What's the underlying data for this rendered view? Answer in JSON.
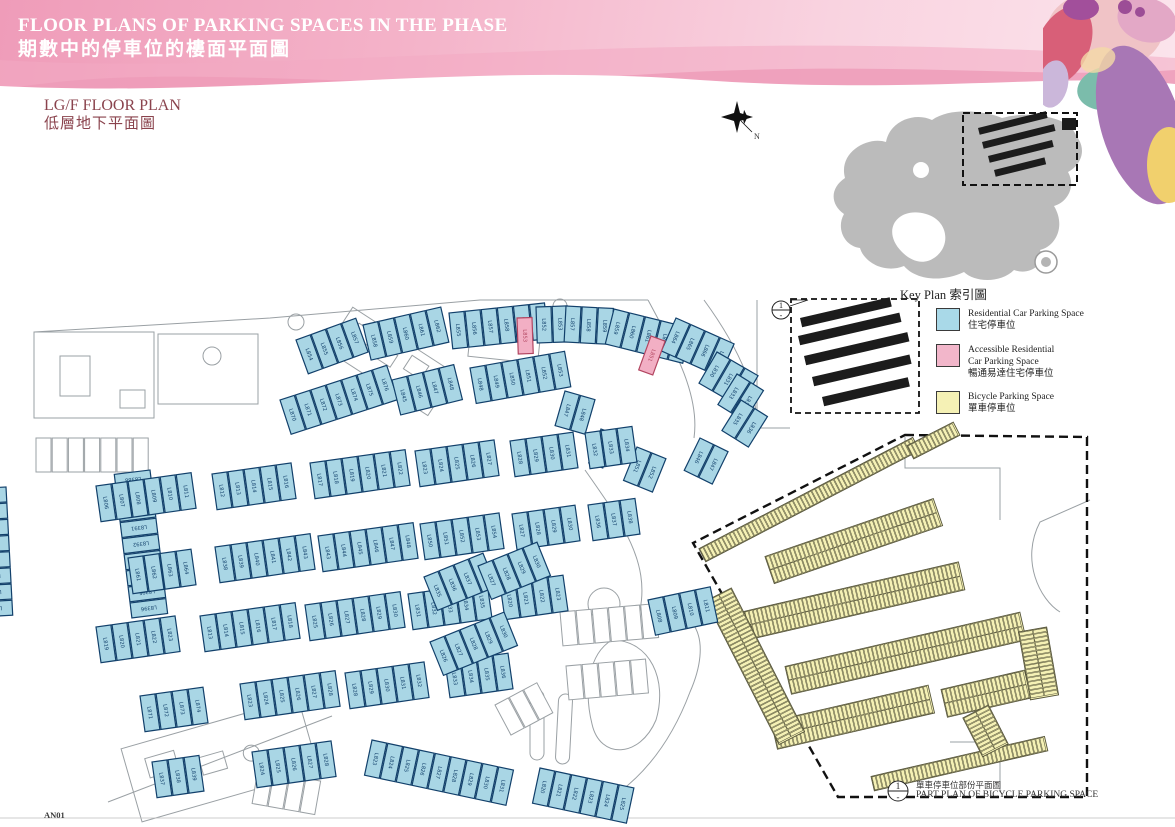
{
  "header": {
    "title_en": "FLOOR PLANS OF PARKING SPACES IN THE PHASE",
    "title_zh": "期數中的停車位的樓面平面圖"
  },
  "floor_title": {
    "en": "LG/F FLOOR PLAN",
    "zh": "低層地下平面圖"
  },
  "key_plan": {
    "caption_en": "Key Plan",
    "caption_zh": "索引圖"
  },
  "compass": {
    "label": "N"
  },
  "legend": {
    "items": [
      {
        "color": "#a9d9e8",
        "en1": "Residential Car Parking Space",
        "en2": "",
        "zh": "住宅停車位"
      },
      {
        "color": "#f2b6ca",
        "en1": "Accessible Residential",
        "en2": "Car Parking Space",
        "zh": "暢通易達住宅停車位"
      },
      {
        "color": "#f5f1b5",
        "en1": "Bicycle Parking Space",
        "en2": "",
        "zh": "單車停車位"
      }
    ]
  },
  "part_plan": {
    "ref": "1",
    "zh": "單車停車位部份平面圖",
    "en": "PART PLAN OF BICYCLE PARKING SPACE"
  },
  "sheet_no": "AN01",
  "plan": {
    "colors": {
      "blue_fill": "#a9d6e5",
      "blue_stroke": "#12406b",
      "pink_fill": "#f2afc4",
      "pink_stroke": "#b24560",
      "yellow_fill": "#f5f1b5",
      "yellow_stroke": "#55543a",
      "gray": "#9aa0a4",
      "black": "#1c1c1c"
    },
    "space": {
      "w": 15,
      "h": 36,
      "pitch": 16.2
    },
    "blue_clusters": [
      [
        296,
        340,
        -20,
        4,
        854
      ],
      [
        363,
        325,
        -13,
        5,
        858
      ],
      [
        449,
        313,
        -6,
        6,
        855
      ],
      [
        536,
        307,
        -2,
        2,
        852
      ],
      [
        566,
        306,
        3,
        3,
        857
      ],
      [
        614,
        309,
        14,
        5,
        859
      ],
      [
        676,
        318,
        24,
        4,
        864
      ],
      [
        717,
        352,
        30,
        3,
        830
      ],
      [
        737,
        374,
        32,
        2,
        833
      ],
      [
        741,
        400,
        32,
        2,
        835
      ],
      [
        565,
        391,
        16,
        2,
        847
      ],
      [
        601,
        429,
        20,
        1,
        849
      ],
      [
        637,
        447,
        22,
        2,
        851
      ],
      [
        700,
        438,
        26,
        2,
        846
      ],
      [
        280,
        400,
        -18,
        7,
        870
      ],
      [
        392,
        380,
        -14,
        4,
        845
      ],
      [
        470,
        368,
        -10,
        6,
        848
      ],
      [
        150,
        470,
        83,
        9,
        8388
      ],
      [
        6,
        487,
        87,
        8,
        8630
      ],
      [
        96,
        486,
        -8,
        6,
        806
      ],
      [
        212,
        474,
        -8,
        5,
        812
      ],
      [
        310,
        463,
        -8,
        6,
        817
      ],
      [
        415,
        451,
        -8,
        5,
        823
      ],
      [
        510,
        441,
        -8,
        4,
        828
      ],
      [
        585,
        433,
        -8,
        3,
        832
      ],
      [
        128,
        558,
        -8,
        4,
        861
      ],
      [
        215,
        547,
        -8,
        6,
        838
      ],
      [
        318,
        536,
        -8,
        6,
        843
      ],
      [
        420,
        524,
        -8,
        5,
        850
      ],
      [
        512,
        514,
        -8,
        4,
        827
      ],
      [
        588,
        505,
        -8,
        3,
        836
      ],
      [
        96,
        627,
        -8,
        5,
        819
      ],
      [
        200,
        616,
        -8,
        6,
        813
      ],
      [
        305,
        605,
        -8,
        6,
        825
      ],
      [
        408,
        594,
        -8,
        5,
        831
      ],
      [
        500,
        584,
        -8,
        4,
        820
      ],
      [
        140,
        696,
        -8,
        4,
        871
      ],
      [
        240,
        684,
        -8,
        6,
        823
      ],
      [
        345,
        673,
        -8,
        5,
        828
      ],
      [
        445,
        662,
        -8,
        4,
        833
      ],
      [
        152,
        762,
        -8,
        3,
        837
      ],
      [
        252,
        752,
        -8,
        5,
        824
      ],
      [
        372,
        740,
        12,
        9,
        823
      ],
      [
        540,
        768,
        12,
        6,
        820
      ],
      [
        424,
        577,
        -22,
        4,
        835
      ],
      [
        478,
        566,
        -22,
        4,
        827
      ],
      [
        430,
        642,
        -22,
        5,
        826
      ],
      [
        648,
        600,
        -12,
        4,
        808
      ]
    ],
    "pink_spaces": [
      [
        517,
        318,
        -2,
        "L853"
      ],
      [
        651,
        336,
        20,
        "L851"
      ]
    ],
    "gray_rows": [
      [
        36,
        438,
        0,
        7
      ],
      [
        560,
        612,
        -5,
        6
      ],
      [
        566,
        666,
        -5,
        5
      ],
      [
        495,
        705,
        -28,
        3
      ],
      [
        258,
        770,
        10,
        4
      ]
    ],
    "bike_bands": [
      [
        700,
        549,
        -27.5,
        57,
        1
      ],
      [
        766,
        557,
        -19,
        42,
        2
      ],
      [
        745,
        612,
        -13,
        52,
        2
      ],
      [
        786,
        667,
        -13,
        57,
        2
      ],
      [
        772,
        722,
        -13,
        38,
        2
      ],
      [
        942,
        690,
        -13,
        20,
        2
      ],
      [
        872,
        777,
        -13,
        42,
        1
      ],
      [
        731,
        589,
        63,
        38,
        2
      ],
      [
        908,
        446,
        -27,
        12,
        1
      ],
      [
        1046,
        628,
        80,
        16,
        2
      ],
      [
        988,
        706,
        63,
        10,
        2
      ]
    ],
    "black_bands": [
      [
        800,
        318,
        -13,
        92
      ],
      [
        798,
        336,
        -13,
        104
      ],
      [
        804,
        356,
        -13,
        106
      ],
      [
        812,
        377,
        -13,
        100
      ],
      [
        822,
        397,
        -13,
        88
      ]
    ]
  }
}
